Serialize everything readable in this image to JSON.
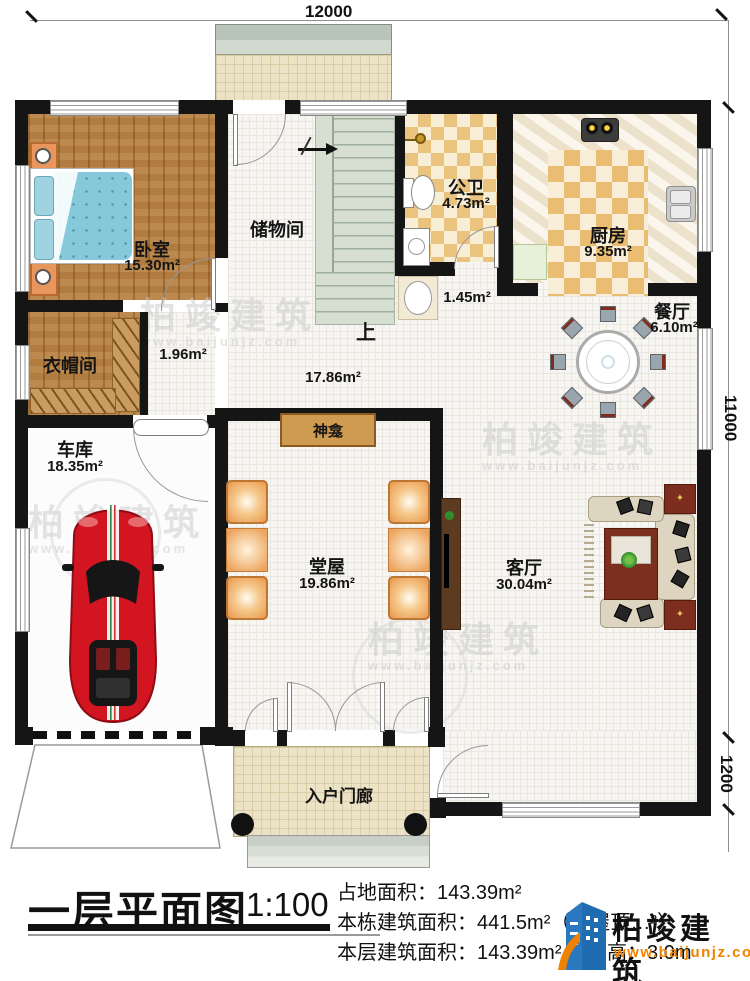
{
  "dimensions": {
    "top": "12000",
    "right_upper": "11000",
    "right_lower": "1200"
  },
  "rooms": {
    "bedroom": {
      "name": "卧室",
      "area": "15.30m²"
    },
    "storage": {
      "name": "储物间"
    },
    "bath": {
      "name": "公卫",
      "area": "4.73m²"
    },
    "kitchen": {
      "name": "厨房",
      "area": "9.35m²"
    },
    "dining": {
      "name": "餐厅",
      "area": "6.10m²"
    },
    "cloak": {
      "name": "衣帽间",
      "area": "1.96m²"
    },
    "garage": {
      "name": "车库",
      "area": "18.35m²"
    },
    "hall": {
      "name": "堂屋",
      "area": "19.86m²"
    },
    "living": {
      "name": "客厅",
      "area": "30.04m²"
    },
    "porch": {
      "name": "入户门廊"
    },
    "shrine": {
      "name": "神龛"
    },
    "corridor": {
      "area": "17.86m²"
    },
    "washnook": {
      "area": "1.45m²"
    },
    "stairs": {
      "up": "上"
    }
  },
  "watermark": {
    "brand": "柏竣建筑",
    "url": "www.baijunjz.com"
  },
  "logo": {
    "brand": "柏竣建筑",
    "url": "www.baijunjz.com"
  },
  "title_block": {
    "title": "一层平面图",
    "scale": "1:100",
    "line1": "占地面积：143.39m²",
    "line2": "本栋建筑面积：441.5m²（含屋顶…²）",
    "line3": "本层建筑面积：143.39m²",
    "floor_height": "层高：3.0m"
  },
  "colors": {
    "wall": "#151515",
    "logo_blue": "#1f6cb0",
    "logo_orange": "#ef8200",
    "checker_tan": "#eac47e",
    "wood": "#b17c40"
  }
}
